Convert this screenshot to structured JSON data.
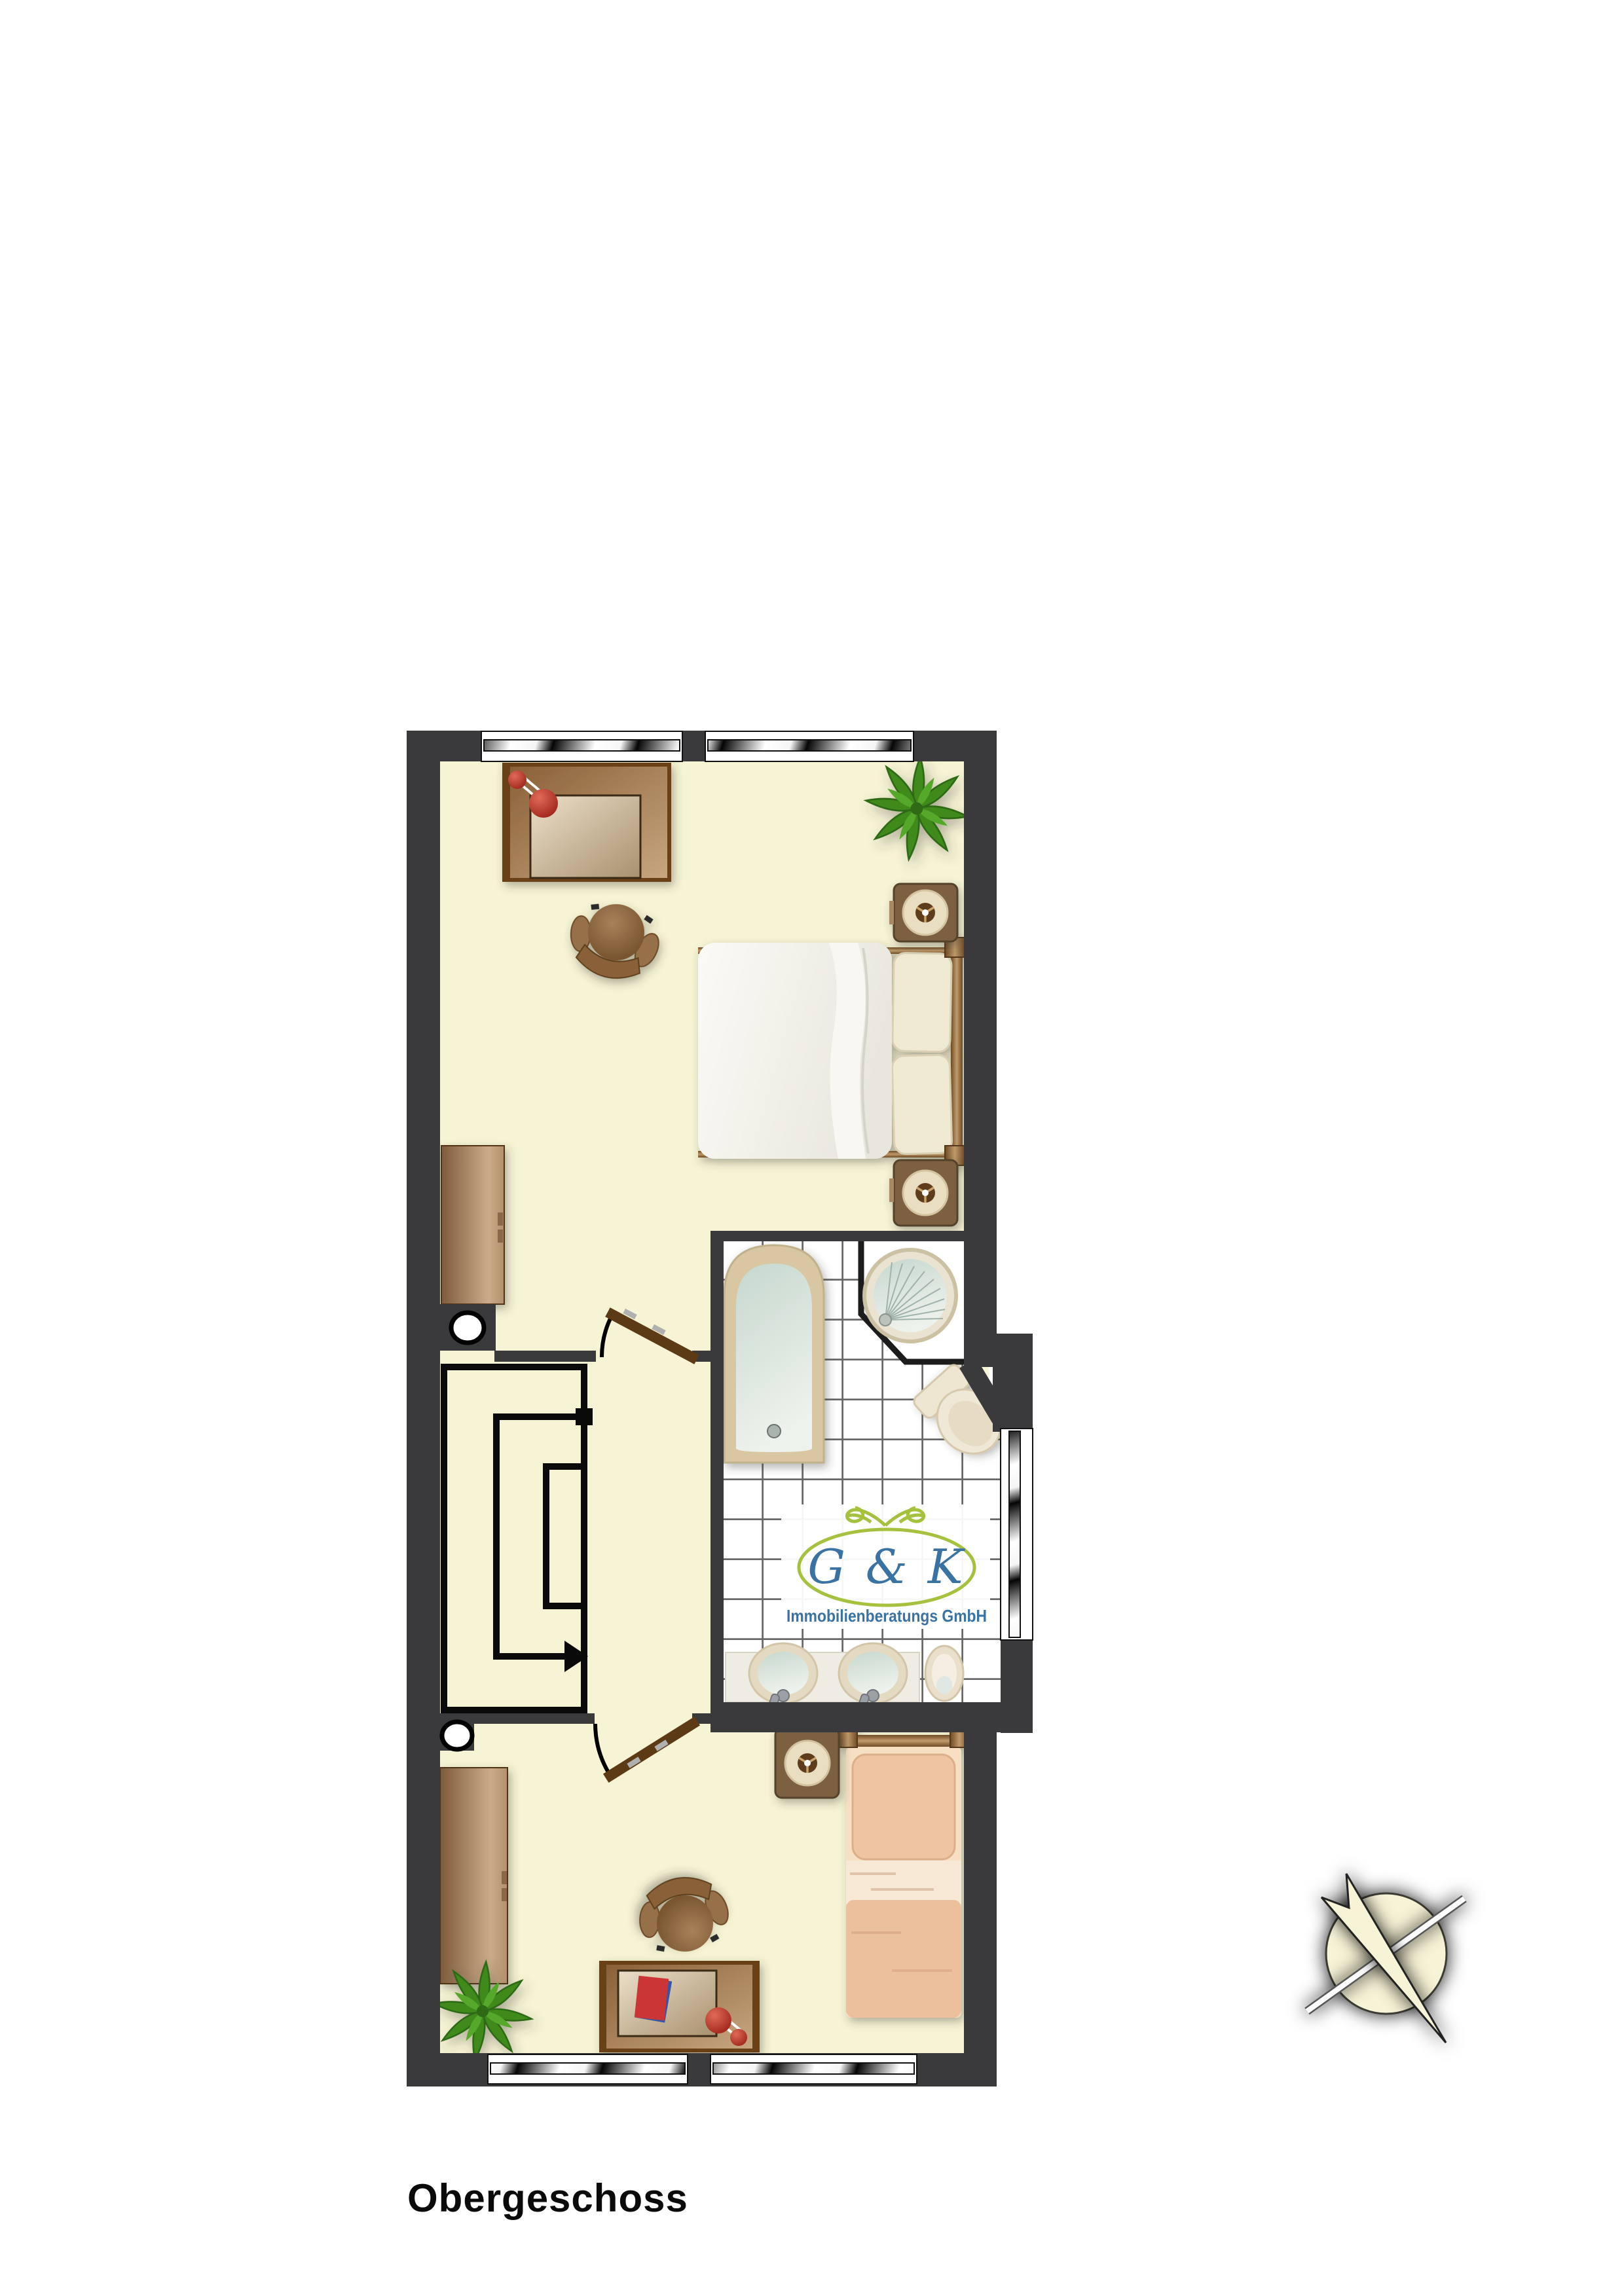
{
  "title": "Obergeschoss",
  "logo": {
    "monogram": "G & K",
    "subtitle": "Immobilienberatungs GmbH"
  },
  "colors": {
    "wall": "#3a3a3c",
    "floor": "#f7f4d5",
    "outline": "#0a0a0a",
    "tile_grout": "#686868",
    "wood_dark": "#6b4012",
    "wood_mid": "#9a7146",
    "wood_light": "#c9ab87",
    "door_leaf": "#5d3a16",
    "linen": "#f2f1ea",
    "pillow": "#f1ead3",
    "peach_pillow": "#eec4a2",
    "peach_blanket": "#ecbf9d",
    "fixture_beige": "#e9dfca",
    "tub_rim": "#d8c7a2",
    "basin_water": "#cfe0d8",
    "lamp_red": "#c23b2e",
    "plant_green": "#3f8a1e",
    "logo_green": "#a6c13d",
    "logo_blue": "#3a72a4",
    "title": "#0a0a0a",
    "compass_fill": "#f7f3d6"
  }
}
